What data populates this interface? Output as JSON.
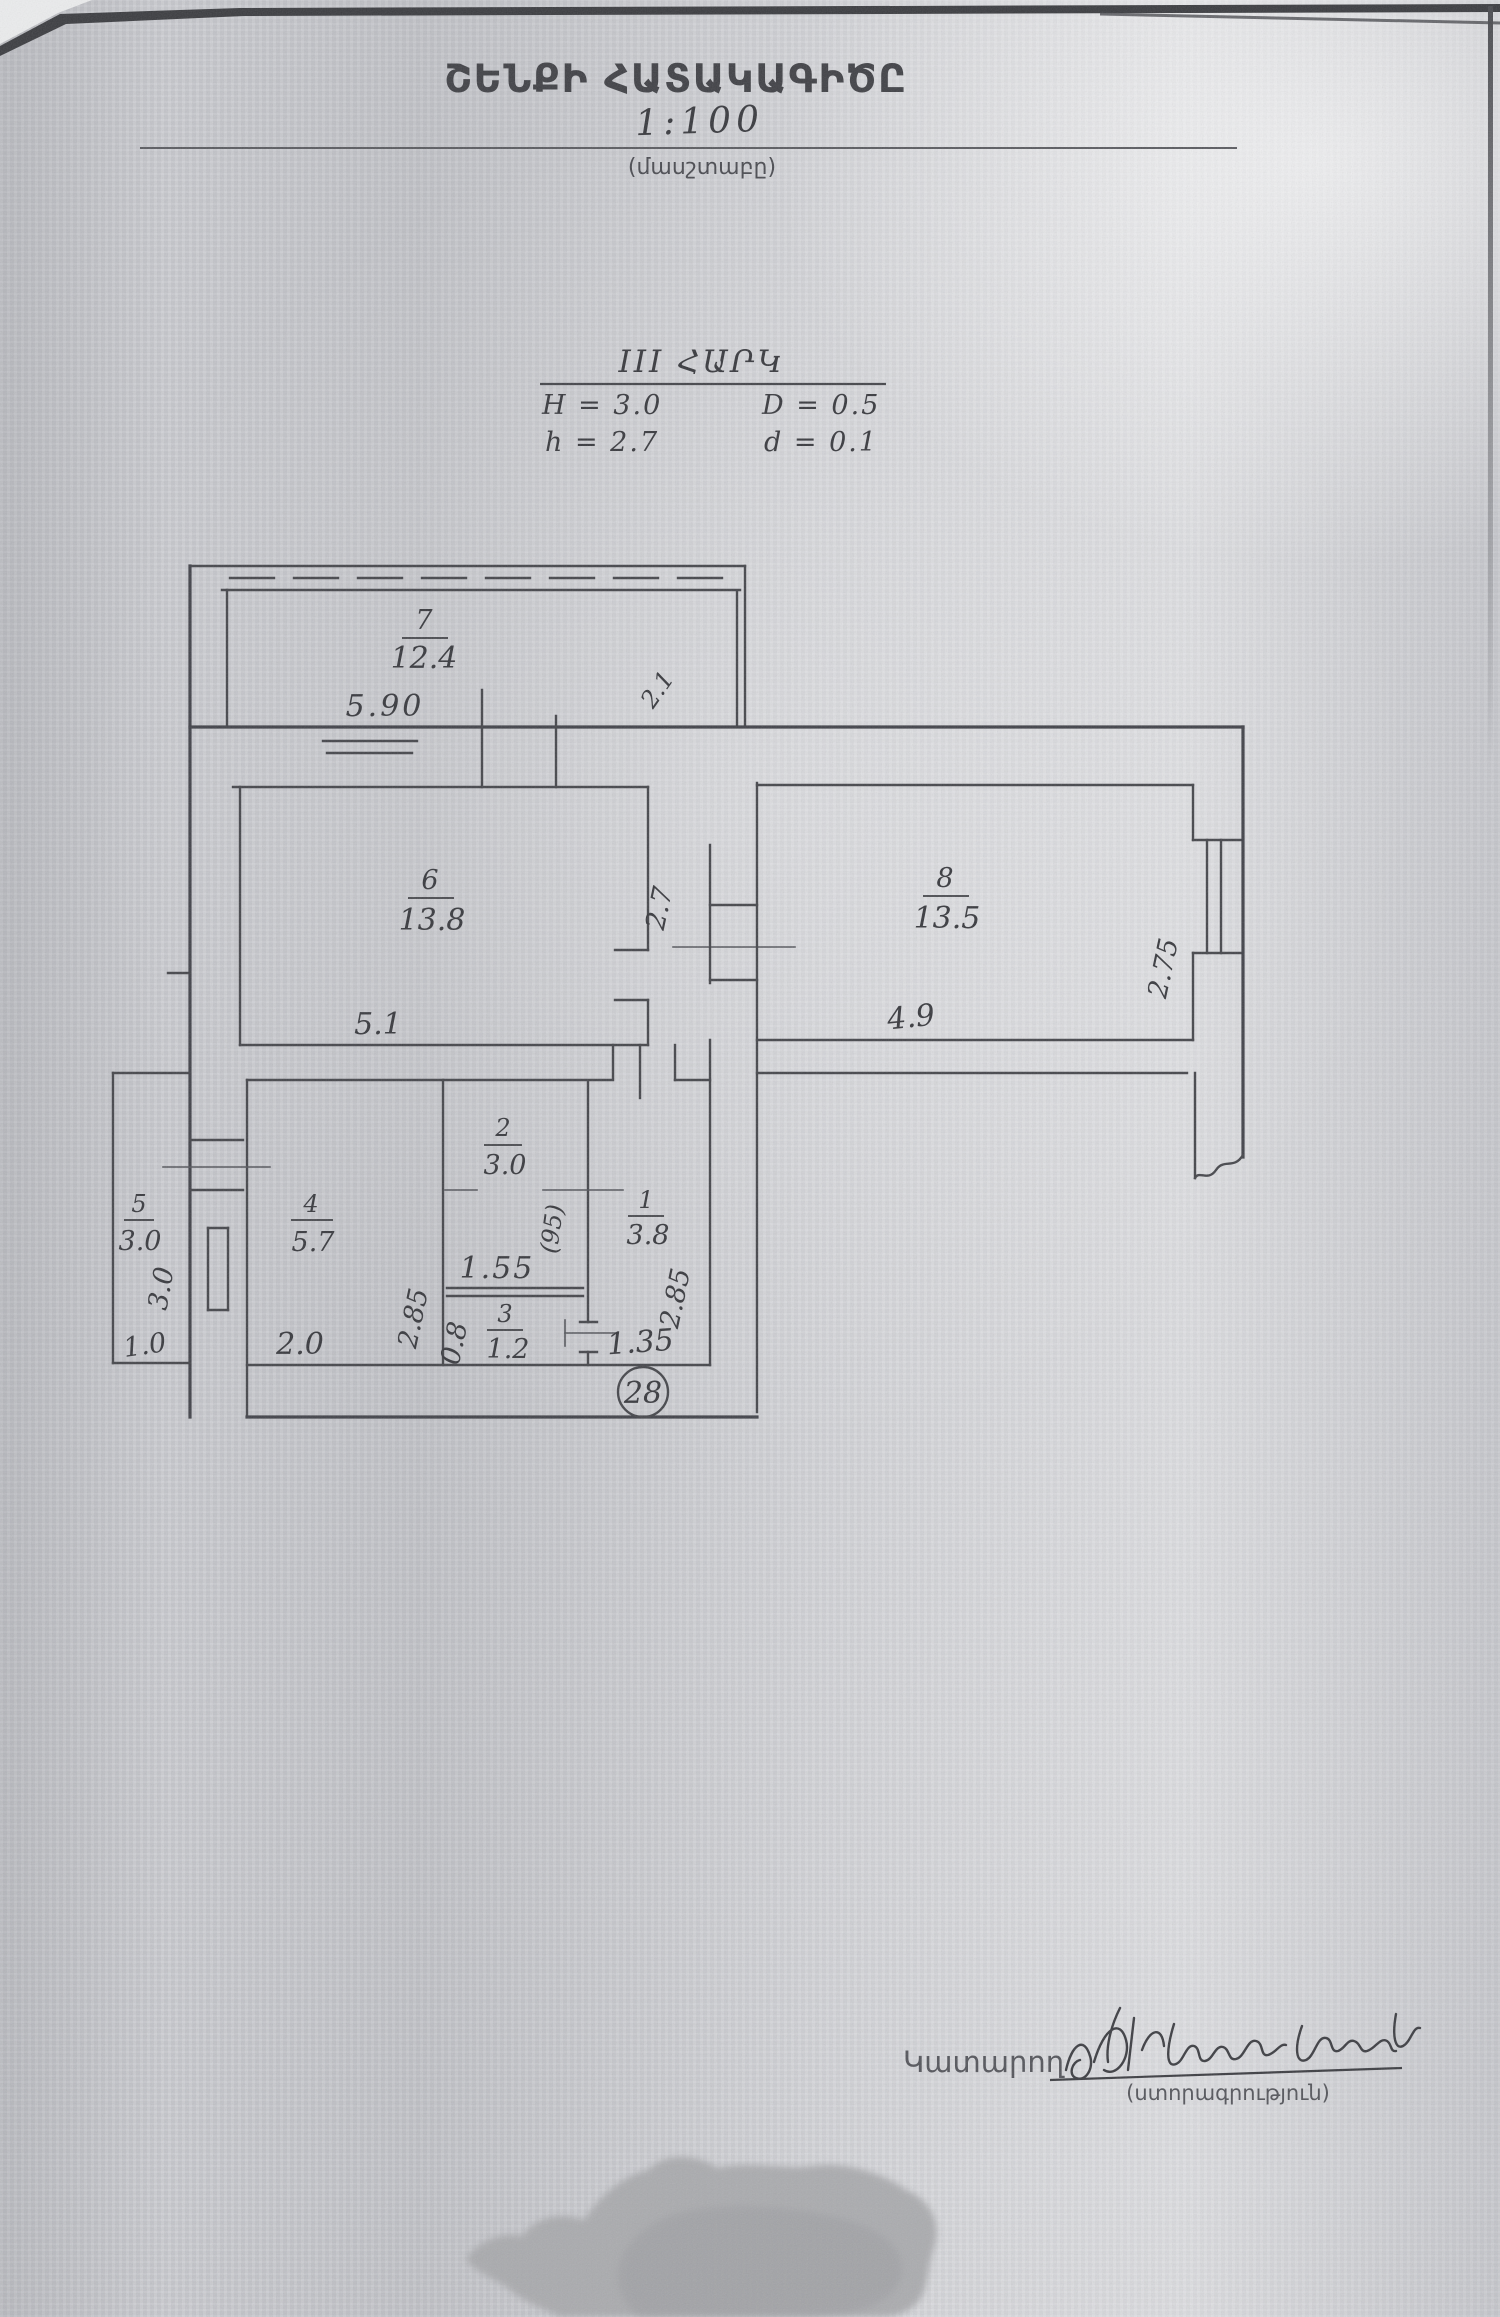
{
  "header": {
    "title": "ՇԵՆՔԻ ՀԱՏԱԿԱԳԻԾԸ",
    "scale_value": "1:100",
    "scale_caption": "(մասշտաբը)"
  },
  "floor_header": {
    "floor_label": "III ՀԱՐԿ",
    "line_H": "H = 3.0",
    "line_D": "D = 0.5",
    "line_h": "h = 2.7",
    "line_d": "d = 0.1"
  },
  "plan": {
    "apartment_number": "28",
    "rooms": [
      {
        "num": "7",
        "area": "12.4"
      },
      {
        "num": "6",
        "area": "13.8"
      },
      {
        "num": "8",
        "area": "13.5"
      },
      {
        "num": "5",
        "area": "3.0"
      },
      {
        "num": "4",
        "area": "5.7"
      },
      {
        "num": "2",
        "area": "3.0"
      },
      {
        "num": "1",
        "area": "3.8"
      },
      {
        "num": "3",
        "area": "1.2"
      }
    ],
    "dims": {
      "balcony7_width": "5.90",
      "balcony7_depth": "2.1",
      "room6_width": "5.1",
      "hall_passage": "2.7",
      "room8_width": "4.9",
      "room8_depth": "2.75",
      "balcony5_depth": "3.0",
      "balcony5_width": "1.0",
      "room4_width": "2.0",
      "room4_depth": "2.85",
      "closet_width": "1.55",
      "door_width": "(95)",
      "room3_depth": "0.8",
      "room1_width": "1.35",
      "room1_depth": "2.85"
    }
  },
  "footer": {
    "executor_label": "Կատարող",
    "signature_caption": "(ստորագրություն)"
  }
}
